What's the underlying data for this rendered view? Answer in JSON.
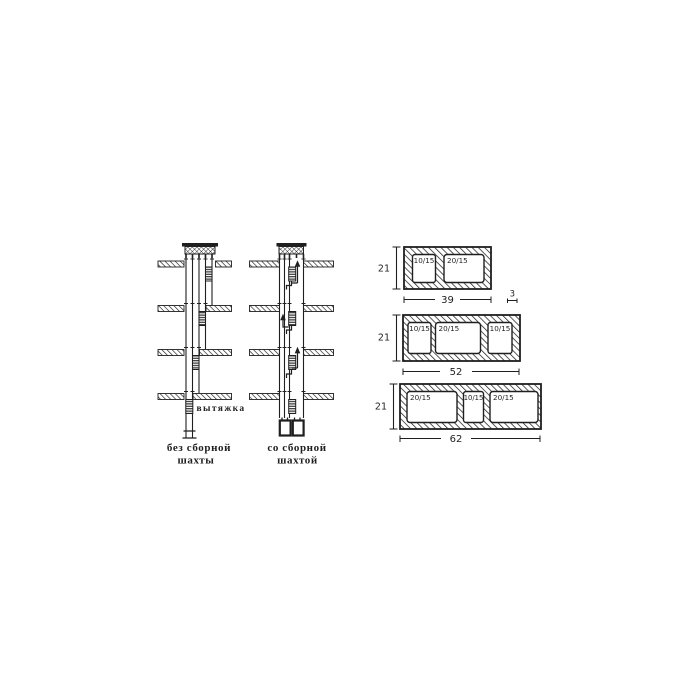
{
  "canvas": {
    "background": "#ffffff",
    "ink": "#1f1f1f"
  },
  "shafts": {
    "exhaust_label": "вытяжка",
    "caption_without": {
      "line1": "без сборной",
      "line2": "шахты"
    },
    "caption_with": {
      "line1": "со сборной",
      "line2": "шахтой"
    }
  },
  "blocks": [
    {
      "height": "21",
      "width": "39",
      "wall": "3",
      "cells": [
        "10/15",
        "20/15"
      ]
    },
    {
      "height": "21",
      "width": "52",
      "cells": [
        "10/15",
        "20/15",
        "10/15"
      ]
    },
    {
      "height": "21",
      "width": "62",
      "cells": [
        "20/15",
        "10/15",
        "20/15"
      ]
    }
  ]
}
